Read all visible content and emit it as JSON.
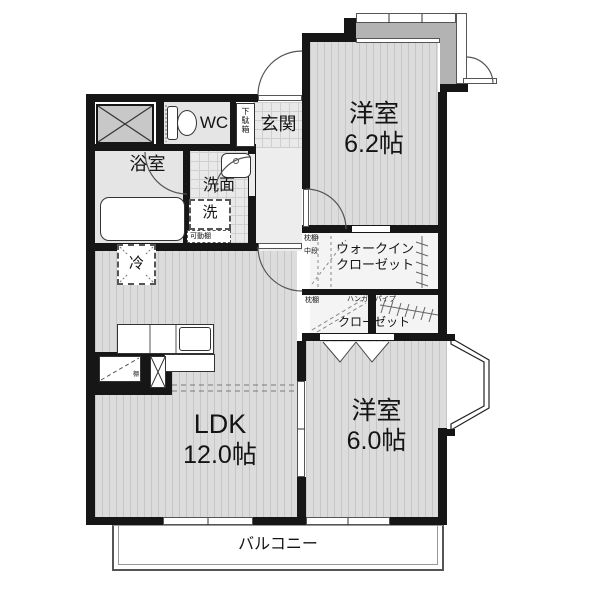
{
  "plan": {
    "rooms": {
      "bedroom_a": {
        "name": "洋室",
        "size": "6.2帖"
      },
      "bedroom_b": {
        "name": "洋室",
        "size": "6.0帖"
      },
      "ldk": {
        "name": "LDK",
        "size": "12.0帖"
      },
      "bathroom": "浴室",
      "washroom": "洗面",
      "toilet": "WC",
      "entrance": "玄関",
      "balcony": "バルコニー",
      "walk_in_closet": {
        "line1": "ウォークイン",
        "line2": "クローゼット",
        "pillow_shelf": "枕棚",
        "middle_shelf": "中段"
      },
      "closet": {
        "name": "クローゼット",
        "pillow_shelf": "枕棚",
        "hanger_pipe": "ハンガーパイプ"
      }
    },
    "fixtures": {
      "shoe_cabinet": "下駄箱",
      "washing_machine": "洗",
      "movable_shelf": "可動棚",
      "refrigerator": "冷",
      "shelf": "棚"
    },
    "colors": {
      "wall": "#161616",
      "room_floor": "#dcdcdc",
      "service_floor": "#e5e5e5",
      "porch": "#b3b3b3",
      "closet_floor": "#f4f4f4"
    }
  }
}
